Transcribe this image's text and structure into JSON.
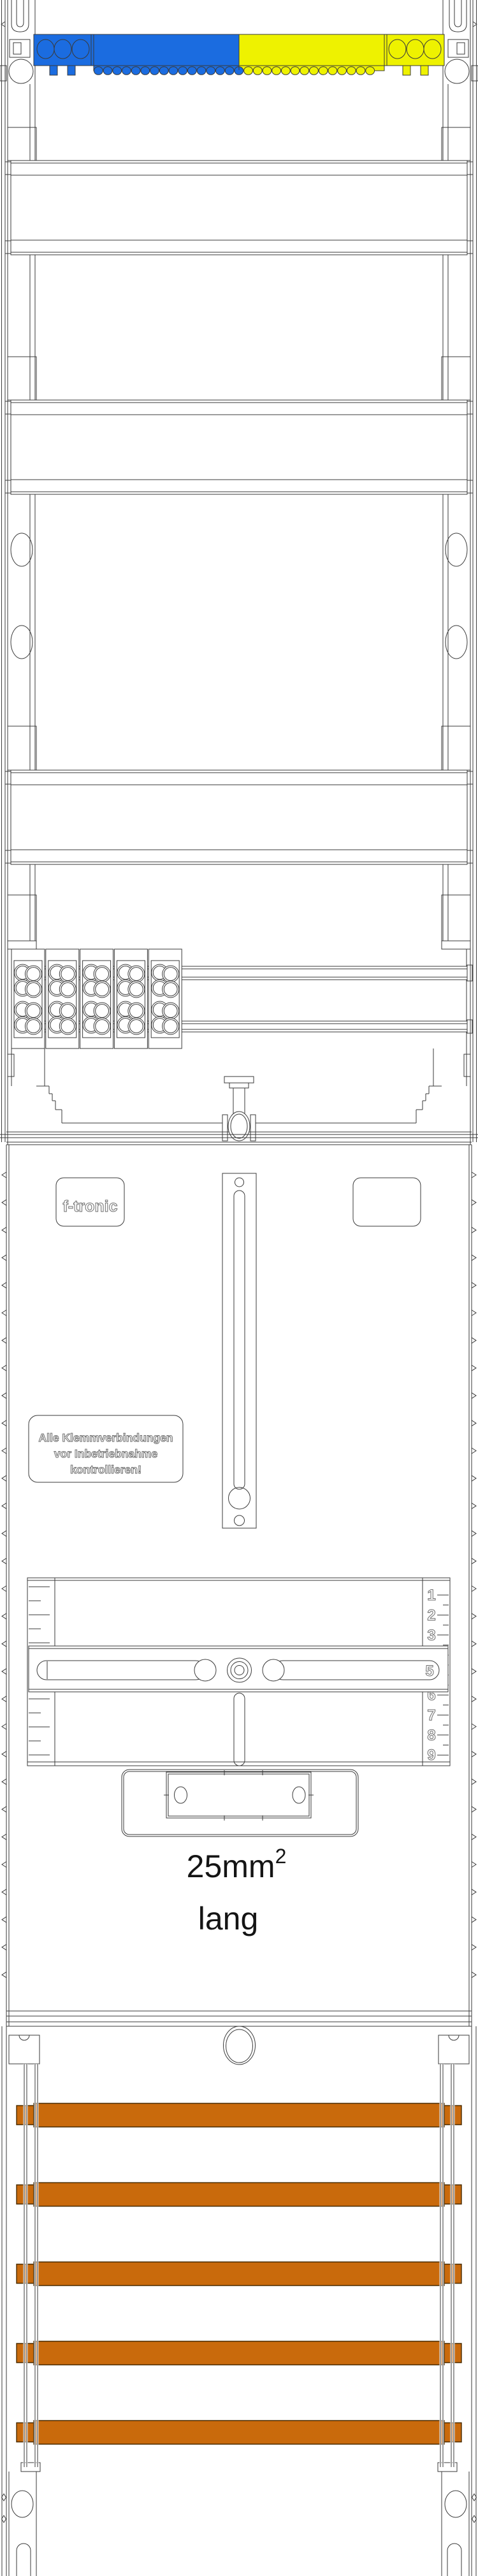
{
  "drawing": {
    "brand": {
      "logo": "f-tronic"
    },
    "warning_label": {
      "lines": [
        "Alle Klemmverbindungen",
        "vor Inbetriebnahme",
        "kontrollieren!"
      ]
    },
    "cable_spec": {
      "value": "25mm",
      "superscript": "2",
      "line2": "lang"
    },
    "clamp_scale": {
      "numbers": [
        "1",
        "2",
        "3",
        "4",
        "5",
        "6",
        "7",
        "8",
        "9"
      ]
    },
    "busbars": {
      "count": 5
    },
    "colors": {
      "line": "#3a3a3a",
      "blue": "#1b6ce0",
      "yellow": "#eef200",
      "busbar": "#c96a0c",
      "busbar_edge": "#4a2b00",
      "text": "#141414",
      "hollow_stroke": "#6d6d6d"
    }
  }
}
